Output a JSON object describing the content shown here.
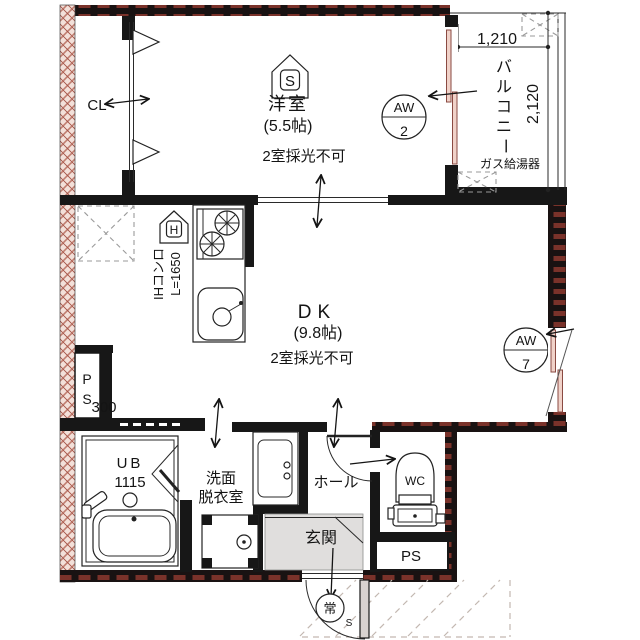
{
  "floor_plan": {
    "rooms": {
      "western_room": {
        "label": "洋室",
        "size": "(5.5帖)",
        "lighting_note": "2室採光不可",
        "shade_badge": "S"
      },
      "dk": {
        "label": "DK",
        "size": "(9.8帖)",
        "lighting_note": "2室採光不可"
      },
      "balcony": {
        "label": "バルコニー",
        "chars": [
          "バ",
          "ル",
          "コ",
          "ニ",
          "ー"
        ]
      },
      "closet": {
        "label": "CL"
      },
      "unit_bath": {
        "label": "UB",
        "size": "1115"
      },
      "washroom": {
        "label_line1": "洗面",
        "label_line2": "脱衣室"
      },
      "hall": {
        "label": "ホール"
      },
      "entrance": {
        "label": "玄関",
        "door_mark": "常",
        "door_mark_sub": "S"
      },
      "wc": {
        "label": "WC"
      },
      "pipe_space_left": {
        "chars": [
          "P",
          "S"
        ],
        "dimension": "300"
      },
      "pipe_space_bottom": {
        "label": "PS"
      }
    },
    "kitchen": {
      "badge": "H",
      "stove_label": "IHコンロ",
      "counter_length": "L=1650"
    },
    "equipment": {
      "gas_water_heater": "ガス給湯器"
    },
    "windows": {
      "aw2": {
        "code": "AW",
        "number": "2"
      },
      "aw7": {
        "code": "AW",
        "number": "7"
      }
    },
    "dimensions": {
      "balcony_width": "1,210",
      "balcony_depth": "2,120"
    },
    "colors": {
      "exterior_wall": "#7a322a",
      "interior_wall": "#171717",
      "hatch_wall": "#c07d6f",
      "tile": "#e0dedd"
    }
  }
}
